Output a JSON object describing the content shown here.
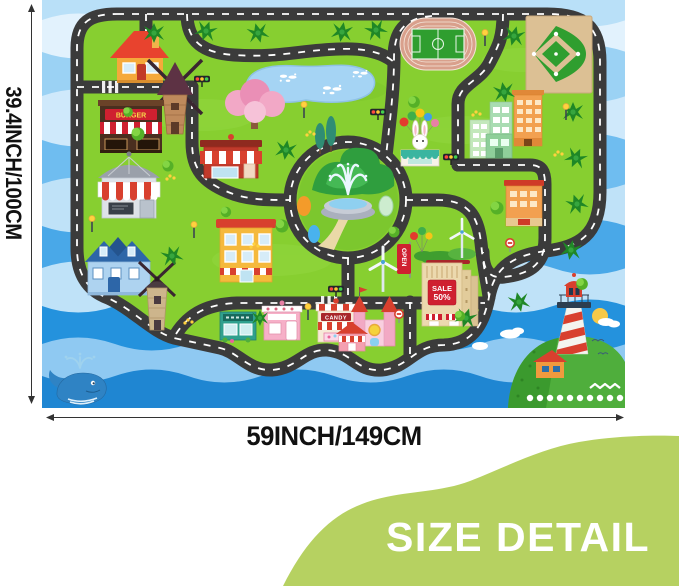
{
  "annotation": {
    "height_label": "39.4INCH/100CM",
    "width_label": "59INCH/149CM",
    "badge_label": "SIZE DETAIL",
    "badge_color": "#b6d161",
    "line_color": "#333333"
  },
  "playmat": {
    "signs": {
      "burger": "BURGER",
      "candy": "CANDY",
      "sale_line1": "SALE",
      "sale_line2": "50%",
      "open": "OPEN"
    },
    "colors": {
      "grass": "#87cf30",
      "road": "#3b3b3b",
      "road_dash": "#ffffff",
      "water_light": "#bfe2f8",
      "water_deep": "#2492dd",
      "pond": "#a5d4f4",
      "sign_red": "#cf2030"
    },
    "features": [
      "city roads",
      "roundabout fountain",
      "pond",
      "soccer field",
      "baseball field",
      "shops",
      "castle",
      "windmills",
      "wind turbines",
      "lighthouse island",
      "whale"
    ]
  }
}
